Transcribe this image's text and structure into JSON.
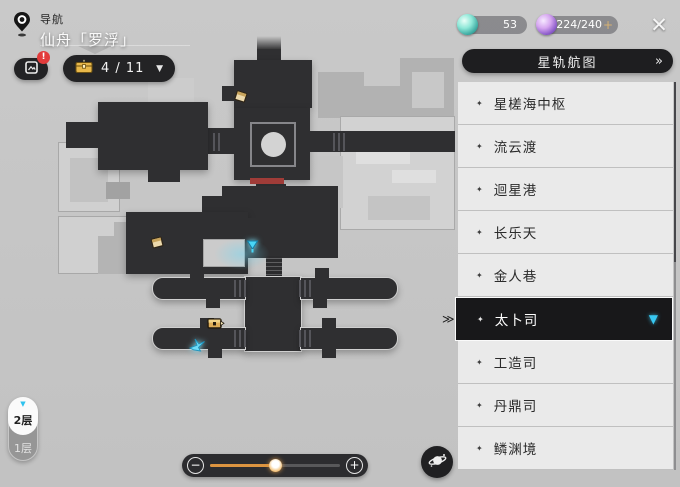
{
  "header": {
    "nav_label": "导航",
    "world_name": "仙舟「罗浮」",
    "close_icon": "✕"
  },
  "toolbar": {
    "journal_badge": "!",
    "chest_count": "4 / 11",
    "dropdown_icon": "▼"
  },
  "currencies": [
    {
      "name": "fuel-orb",
      "value": "53"
    },
    {
      "name": "trailblaze-power-orb",
      "value": "224/240",
      "plus": "+"
    }
  ],
  "sidebar": {
    "title": "星轨航图",
    "expand_icon": "»",
    "bullet": "✦",
    "selected_pointer": "≫",
    "selected_chevron": "▼",
    "items": [
      {
        "label": "星槎海中枢",
        "selected": false
      },
      {
        "label": "流云渡",
        "selected": false
      },
      {
        "label": "迴星港",
        "selected": false
      },
      {
        "label": "长乐天",
        "selected": false
      },
      {
        "label": "金人巷",
        "selected": false
      },
      {
        "label": "太卜司",
        "selected": true
      },
      {
        "label": "工造司",
        "selected": false
      },
      {
        "label": "丹鼎司",
        "selected": false
      },
      {
        "label": "鳞渊境",
        "selected": false
      }
    ]
  },
  "floor_selector": {
    "chevron": "▼",
    "floors": [
      "2层",
      "1层"
    ],
    "selected": "2层"
  },
  "zoom_slider": {
    "minus": "−",
    "plus": "+",
    "value_pct": 50
  },
  "map": {
    "markers": [
      {
        "name": "treasure-puzzle-marker",
        "x": 233,
        "y": 88
      },
      {
        "name": "treasure-puzzle-marker",
        "x": 149,
        "y": 234
      },
      {
        "name": "teleport-anchor-marker",
        "x": 245,
        "y": 239
      },
      {
        "name": "treasure-chest-marker",
        "x": 206,
        "y": 314
      },
      {
        "name": "origami-bird-marker",
        "x": 188,
        "y": 336
      }
    ]
  },
  "colors": {
    "accent_cyan": "#38c8f2",
    "accent_orange": "#dc9440",
    "map_dark": "#2f2f31",
    "selected_bg": "#18181a",
    "badge_red": "#e23b3b"
  }
}
